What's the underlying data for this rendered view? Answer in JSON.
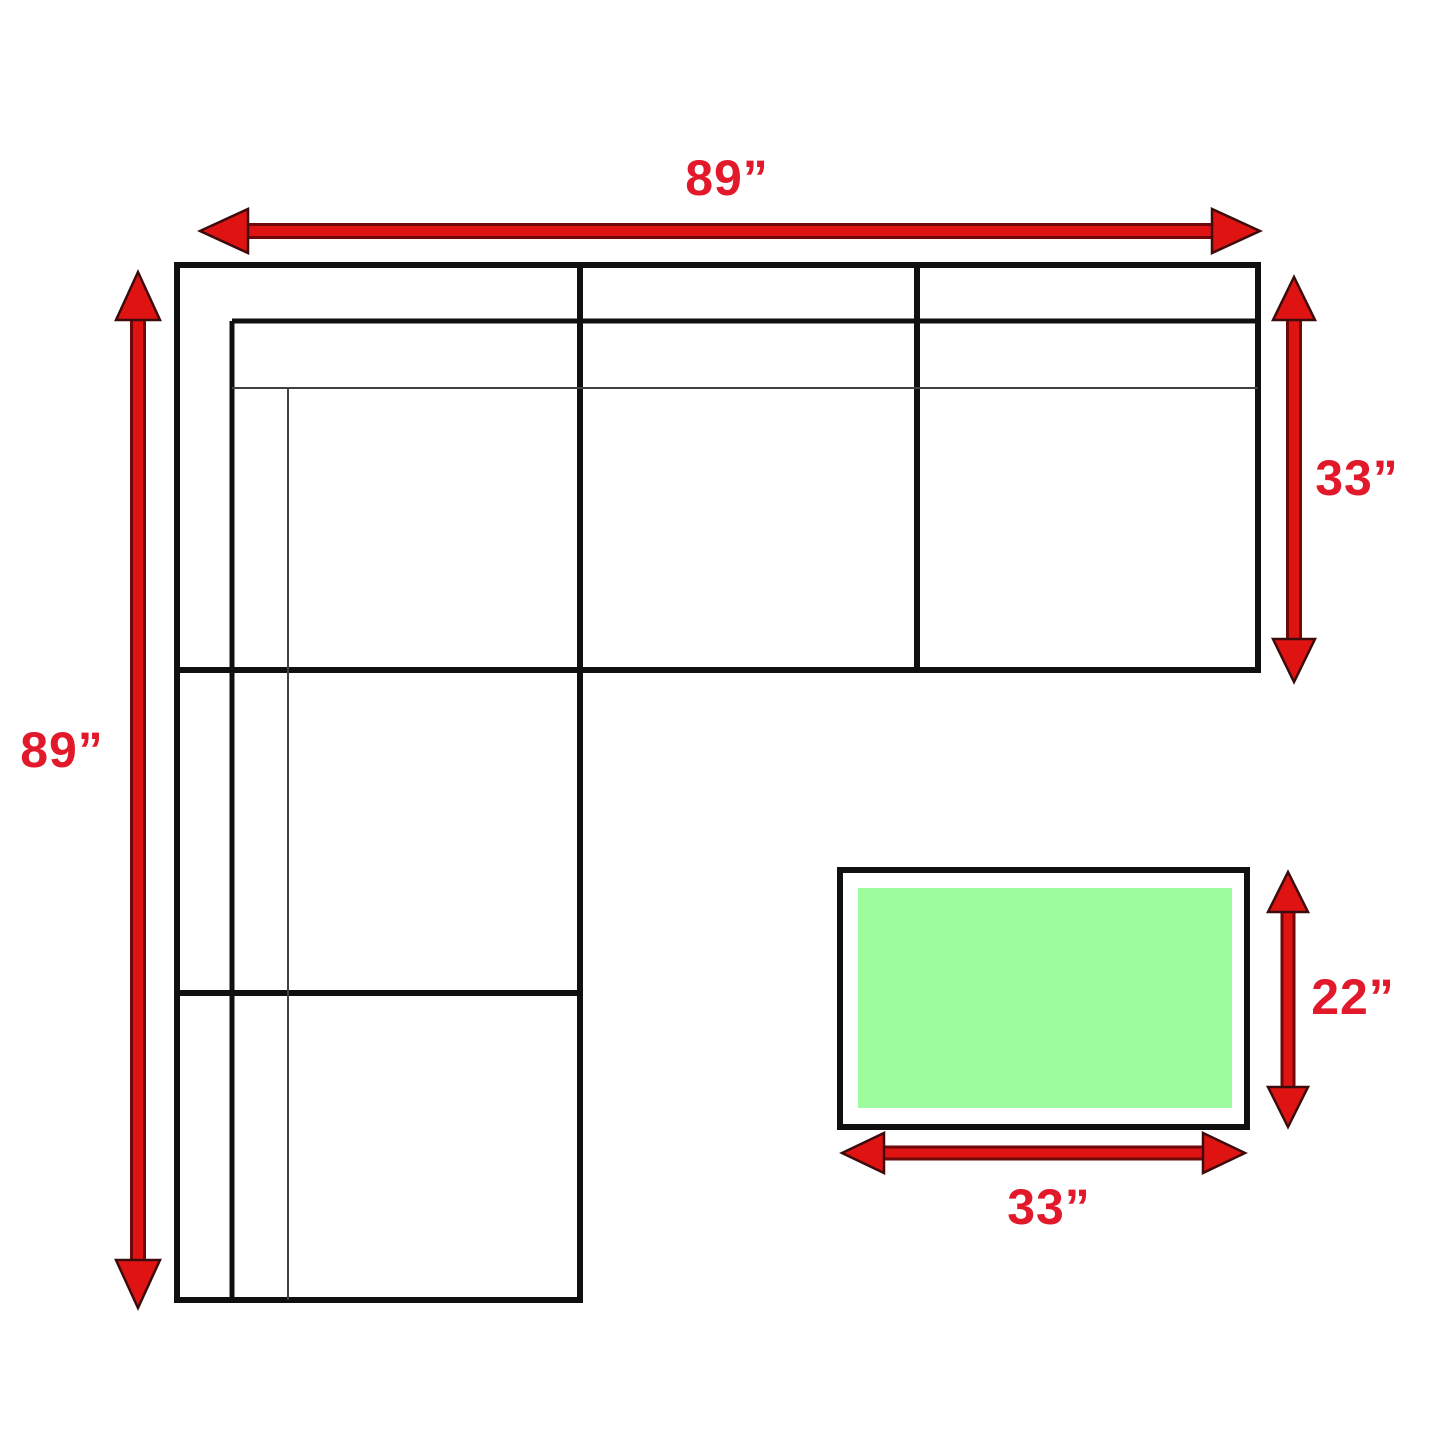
{
  "diagram": {
    "background_color": "#ffffff",
    "outline_color": "#101010",
    "thin_line_color": "#404040",
    "arrow_color": "#e01313",
    "arrow_edge_color": "#6f0808",
    "label_color": "#e2192b",
    "sectional": {
      "width_label": "89”",
      "height_label": "89”",
      "depth_label": "33”"
    },
    "ottoman": {
      "width_label": "33”",
      "depth_label": "22”",
      "fill_color": "#9dfc9d"
    }
  }
}
